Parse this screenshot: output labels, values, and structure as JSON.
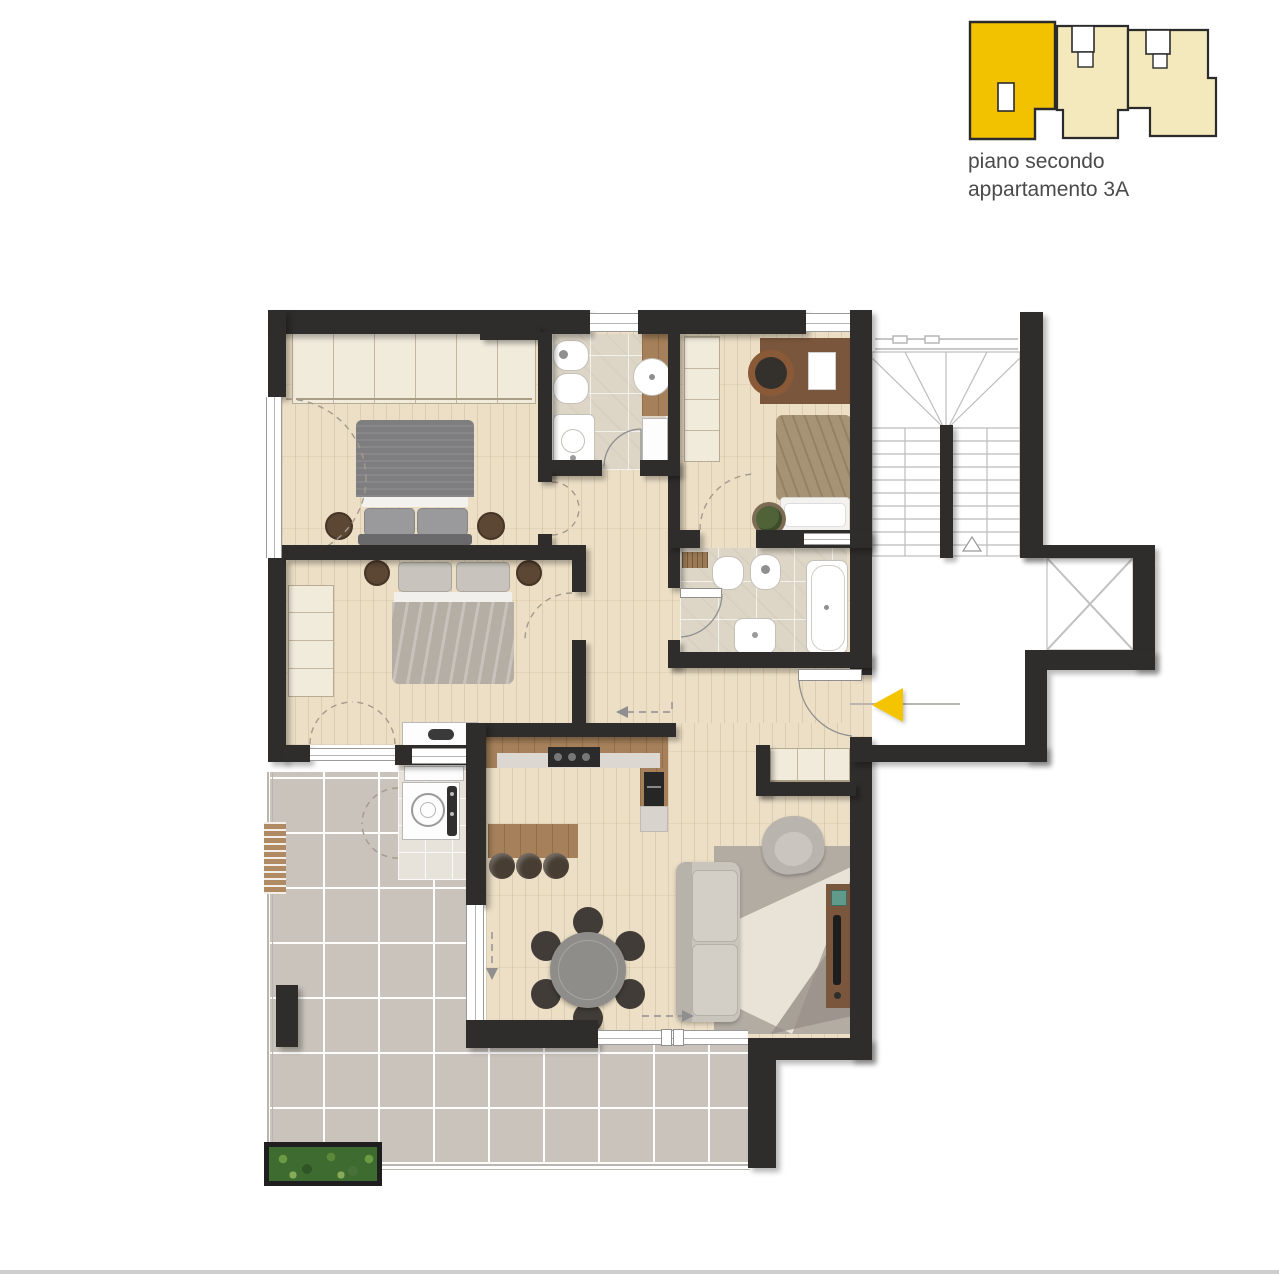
{
  "caption": {
    "line1": "piano secondo",
    "line2": "appartamento 3A"
  },
  "keyplan": {
    "units_count": 3,
    "highlighted_unit": "appartamento 3A",
    "highlight_color": "#F2C200",
    "neutral_color": "#F3E9BC",
    "outline_color": "#2b2b2b"
  },
  "palette": {
    "background": "#ffffff",
    "wall": "#2f2d2b",
    "wood_floor": "#ecdfc6",
    "terrace_tile": "#c9c3bb",
    "bathroom_tile": "#ddd6c7",
    "accent_yellow": "#F5C400"
  },
  "entry_marker": {
    "icon": "entry-arrow-icon",
    "shape": "triangle",
    "direction": "left",
    "color": "#F5C400"
  },
  "rooms": [
    {
      "id": "bedroom-double-1",
      "furniture": [
        "wardrobe",
        "double-bed",
        "nightstand",
        "nightstand"
      ]
    },
    {
      "id": "bedroom-double-2",
      "furniture": [
        "wardrobe",
        "double-bed",
        "nightstand",
        "nightstand",
        "dresser"
      ]
    },
    {
      "id": "bedroom-single",
      "furniture": [
        "wardrobe",
        "desk",
        "desk-chair",
        "single-bed",
        "plant"
      ]
    },
    {
      "id": "bathroom-1",
      "fixtures": [
        "bidet",
        "toilet",
        "washbasin",
        "round-basin-vanity",
        "vanity-cabinet"
      ]
    },
    {
      "id": "bathroom-2",
      "fixtures": [
        "bath-mat",
        "bidet",
        "toilet",
        "washbasin",
        "bathtub"
      ]
    },
    {
      "id": "kitchen-living-room",
      "furniture": [
        "kitchen-counter",
        "cooktop",
        "oven-column",
        "island-bar",
        "stool",
        "stool",
        "stool",
        "round-dining-table",
        "dining-chair-x6",
        "sofa",
        "rug",
        "armchair",
        "tv-sideboard"
      ]
    },
    {
      "id": "laundry",
      "fixtures": [
        "washing-machine",
        "shelf-counter"
      ]
    },
    {
      "id": "entry-hall",
      "furniture": [
        "built-in-closet"
      ]
    },
    {
      "id": "terrace",
      "features": [
        "tiled-deck",
        "planter",
        "trellis",
        "railing"
      ]
    },
    {
      "id": "balcony-south",
      "features": [
        "tiled-deck"
      ]
    },
    {
      "id": "stairwell",
      "features": [
        "stair-treads",
        "center-spine-wall",
        "direction-triangle",
        "window"
      ]
    },
    {
      "id": "elevator",
      "features": [
        "shaft-cross"
      ]
    }
  ]
}
